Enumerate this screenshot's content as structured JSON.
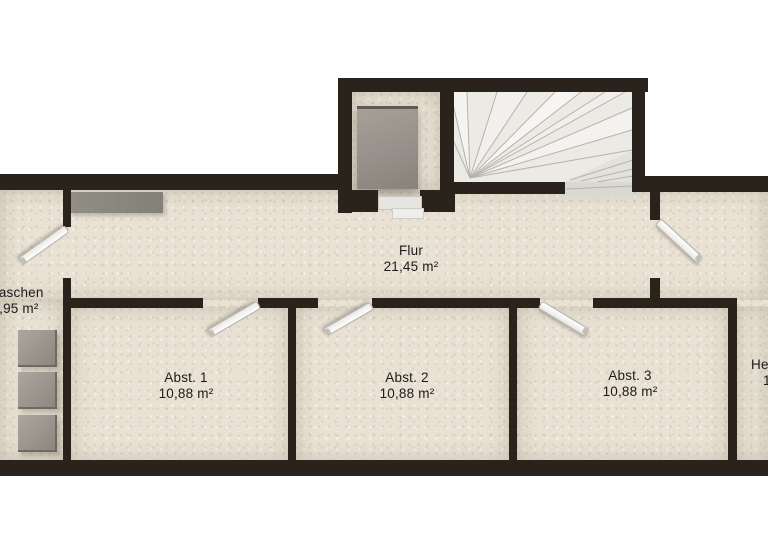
{
  "plan": {
    "type": "floor-plan",
    "rooms": [
      {
        "id": "waschen",
        "label": "Waschen",
        "area": "4,95 m²"
      },
      {
        "id": "flur",
        "label": "Flur",
        "area": "21,45 m²"
      },
      {
        "id": "abst1",
        "label": "Abst. 1",
        "area": "10,88 m²"
      },
      {
        "id": "abst2",
        "label": "Abst. 2",
        "area": "10,88 m²"
      },
      {
        "id": "abst3",
        "label": "Abst. 3",
        "area": "10,88 m²"
      },
      {
        "id": "room-right-clipped",
        "label": "He",
        "area": "1"
      }
    ],
    "objects": [
      "staircase-winder",
      "bed",
      "counter",
      "washing-machine",
      "washing-machine",
      "washing-machine",
      "door-swing-waschen",
      "door-swing-abst1",
      "door-swing-abst2",
      "door-swing-abst3",
      "door-swing-right-corridor"
    ],
    "colors": {
      "background": "#ffffff",
      "wall": "#2a231c",
      "floor": "#e9e2d4",
      "stairs": "#eceae5",
      "object_gray": "#95908a",
      "door_leaf": "#ffffff",
      "text": "#1b1b1b"
    }
  }
}
